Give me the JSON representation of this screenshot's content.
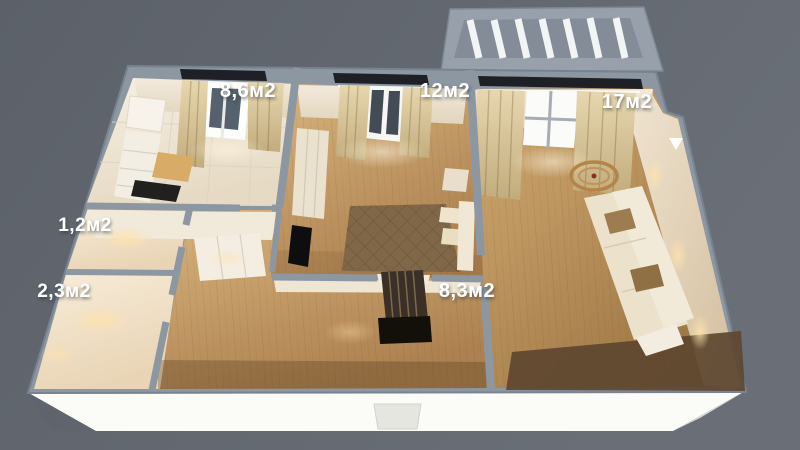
{
  "scene": {
    "description": "3D bird's-eye render of an apartment floor plan",
    "background_color": "#61666e",
    "wall_color": "#8d97a2",
    "facade_color": "#fbfbf8",
    "wood_floor_color": "#c8a167",
    "tile_floor_color": "#eee6d7",
    "label_color": "#ffffff"
  },
  "rooms": [
    {
      "id": "kitchen",
      "area_label": "8,6м2"
    },
    {
      "id": "bedroom",
      "area_label": "12м2"
    },
    {
      "id": "living-room",
      "area_label": "17м2"
    },
    {
      "id": "wc",
      "area_label": "1,2м2"
    },
    {
      "id": "bathroom",
      "area_label": "2,3м2"
    },
    {
      "id": "hallway",
      "area_label": "8,3м2"
    }
  ],
  "features": {
    "balcony": "glazed balcony at top right",
    "entrance_door": "entrance door on bottom facade",
    "furniture": [
      "kitchen-cabinets",
      "cooktop",
      "wardrobe",
      "tv",
      "double-bed",
      "sofa",
      "round-coffee-table",
      "hallway-wardrobe"
    ]
  }
}
